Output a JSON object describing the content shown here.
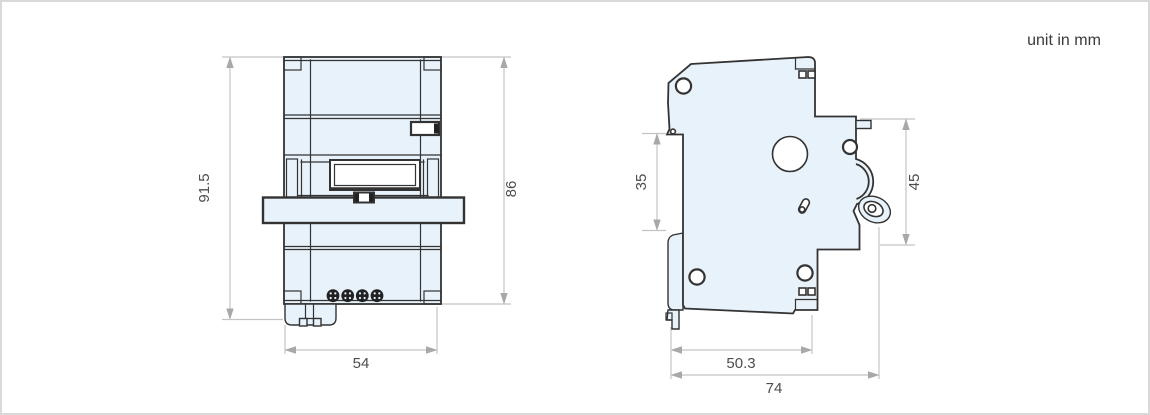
{
  "unit_note": "unit in mm",
  "colors": {
    "body_fill": "#e8f2fa",
    "outline": "#333333",
    "detail_fill": "#ffffff",
    "screw_fill": "#222222",
    "dimension_line": "#c4c4c4",
    "dimension_arrow": "#a8a8a8",
    "dimension_text": "#4d4d4d",
    "page_border": "#d9d9d9",
    "background": "#ffffff"
  },
  "front_view": {
    "dimensions": {
      "overall_height": "91.5",
      "body_height": "86",
      "width": "54"
    }
  },
  "side_view": {
    "dimensions": {
      "din_rail_height": "35",
      "front_section_height": "45",
      "base_depth": "50.3",
      "overall_depth": "74"
    }
  }
}
